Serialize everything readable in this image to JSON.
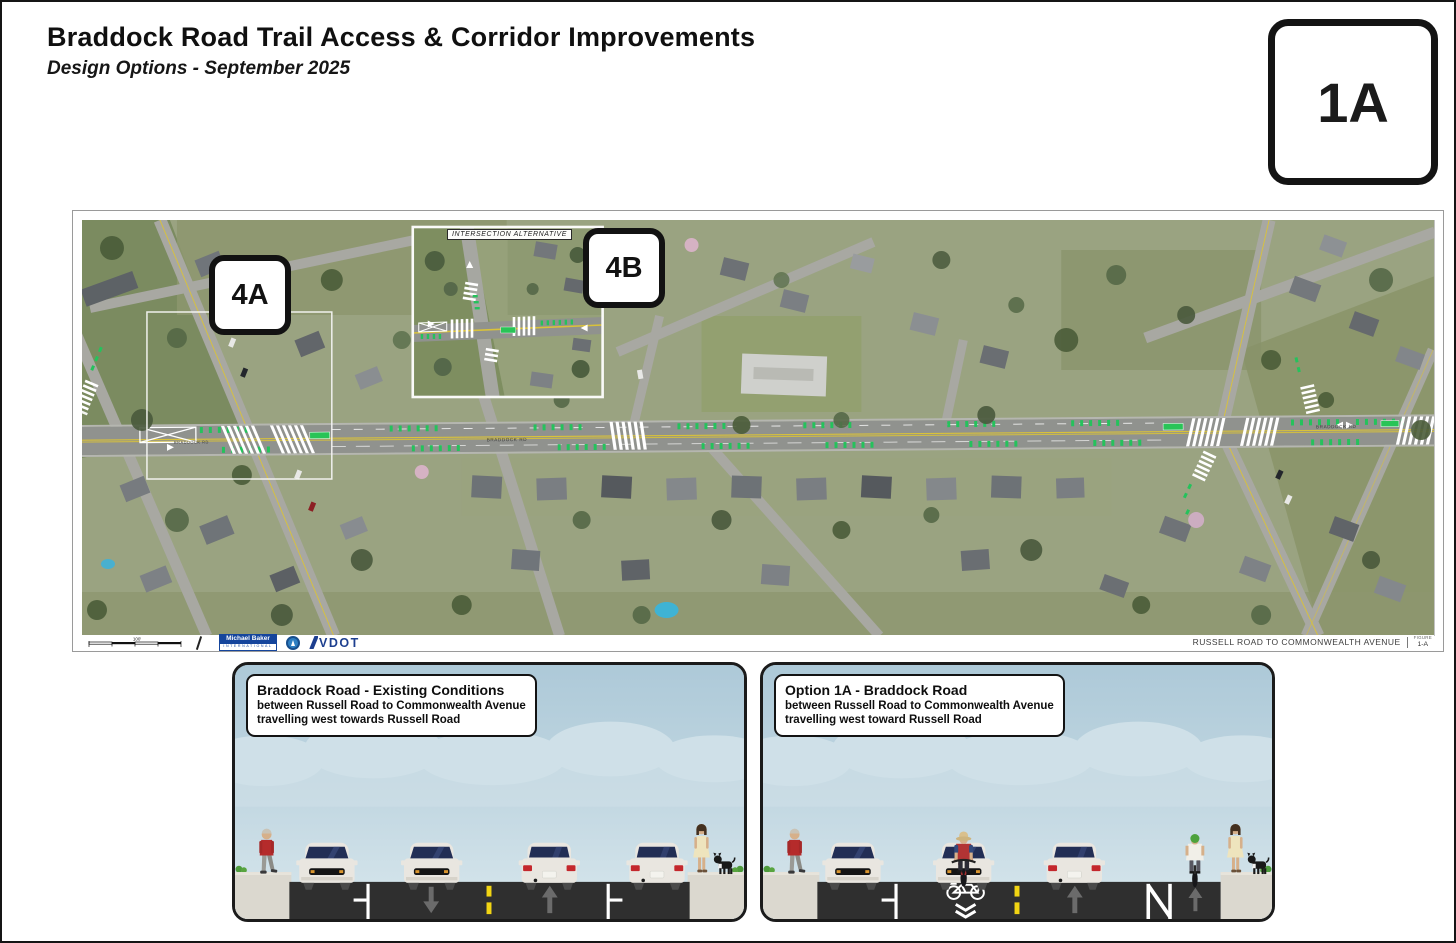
{
  "header": {
    "title": "Braddock Road Trail Access & Corridor Improvements",
    "subtitle": "Design Options - September 2025"
  },
  "sheet_badge": "1A",
  "map": {
    "badge_4a": "4A",
    "badge_4b": "4B",
    "inset_label": "INTERSECTION ALTERNATIVE",
    "road_label": "BRADDOCK RD",
    "footer": {
      "scale_label": "100'",
      "michael_baker_line1": "Michael Baker",
      "michael_baker_line2": "INTERNATIONAL",
      "vdot_label": "VDOT",
      "extent_label": "RUSSELL ROAD TO COMMONWEALTH AVENUE",
      "figure_caption": "FIGURE",
      "figure_number": "1-A"
    }
  },
  "panels": {
    "existing": {
      "title": "Braddock Road - Existing Conditions",
      "line1": "between Russell Road to Commonwealth Avenue",
      "line2": "travelling west towards Russell Road"
    },
    "option": {
      "title": "Option 1A - Braddock Road",
      "line1": "between Russell Road to Commonwealth Avenue",
      "line2": "travelling west toward Russell Road"
    }
  },
  "colors": {
    "bike_green": "#25c25c",
    "centerline_yellow": "#f2d513",
    "road_dark": "#2f2f2f",
    "sky_top": "#adc9d8"
  }
}
